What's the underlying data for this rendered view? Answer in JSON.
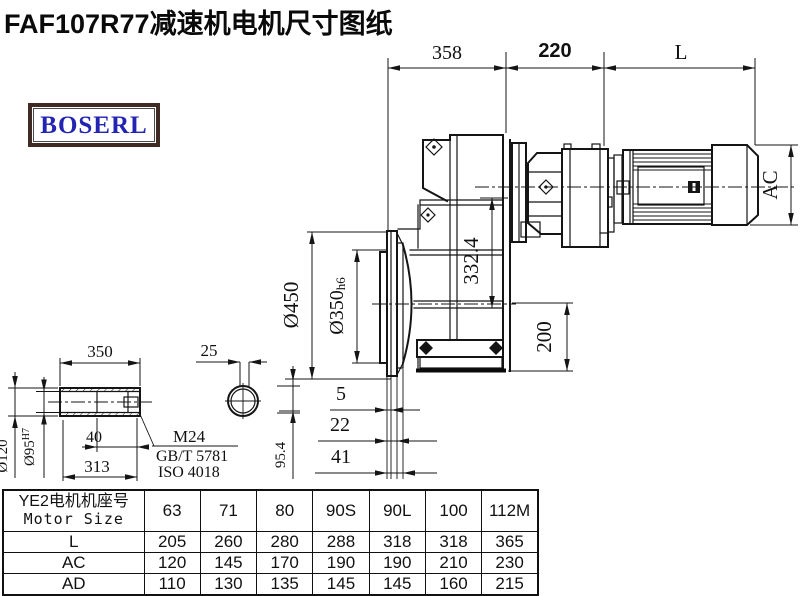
{
  "title": "FAF107R77减速机电机尺寸图纸",
  "logo": {
    "text": "BOSERL"
  },
  "colors": {
    "line": "#151515",
    "logo_border": "#402a24",
    "logo_text": "#2424b4"
  },
  "drawing": {
    "dims": {
      "width_358": "358",
      "width_220": "220",
      "width_L": "L",
      "ac_label": "AC",
      "flange_od": "Ø450",
      "flange_pilot": "Ø350",
      "flange_pilot_tol": "h6",
      "height_3324": "332.4",
      "height_200": "200",
      "offset_5": "5",
      "offset_22": "22",
      "offset_41": "41",
      "height_954": "95.4",
      "shaft_len_350": "350",
      "shaft_sec_25": "25",
      "shaft_40": "40",
      "shaft_313": "313",
      "shaft_od": "Ø120",
      "shaft_bore": "Ø95",
      "shaft_bore_tol": "H7",
      "thread_m24": "M24",
      "std_gb": "GB/T 5781",
      "std_iso": "ISO 4018"
    }
  },
  "table": {
    "header_cn": "YE2电机机座号",
    "header_en": "Motor Size",
    "columns": [
      "63",
      "71",
      "80",
      "90S",
      "90L",
      "100",
      "112M"
    ],
    "rows": [
      {
        "label": "L",
        "values": [
          "205",
          "260",
          "280",
          "288",
          "318",
          "318",
          "365"
        ]
      },
      {
        "label": "AC",
        "values": [
          "120",
          "145",
          "170",
          "190",
          "190",
          "210",
          "230"
        ]
      },
      {
        "label": "AD",
        "values": [
          "110",
          "130",
          "135",
          "145",
          "145",
          "160",
          "215"
        ]
      }
    ]
  }
}
